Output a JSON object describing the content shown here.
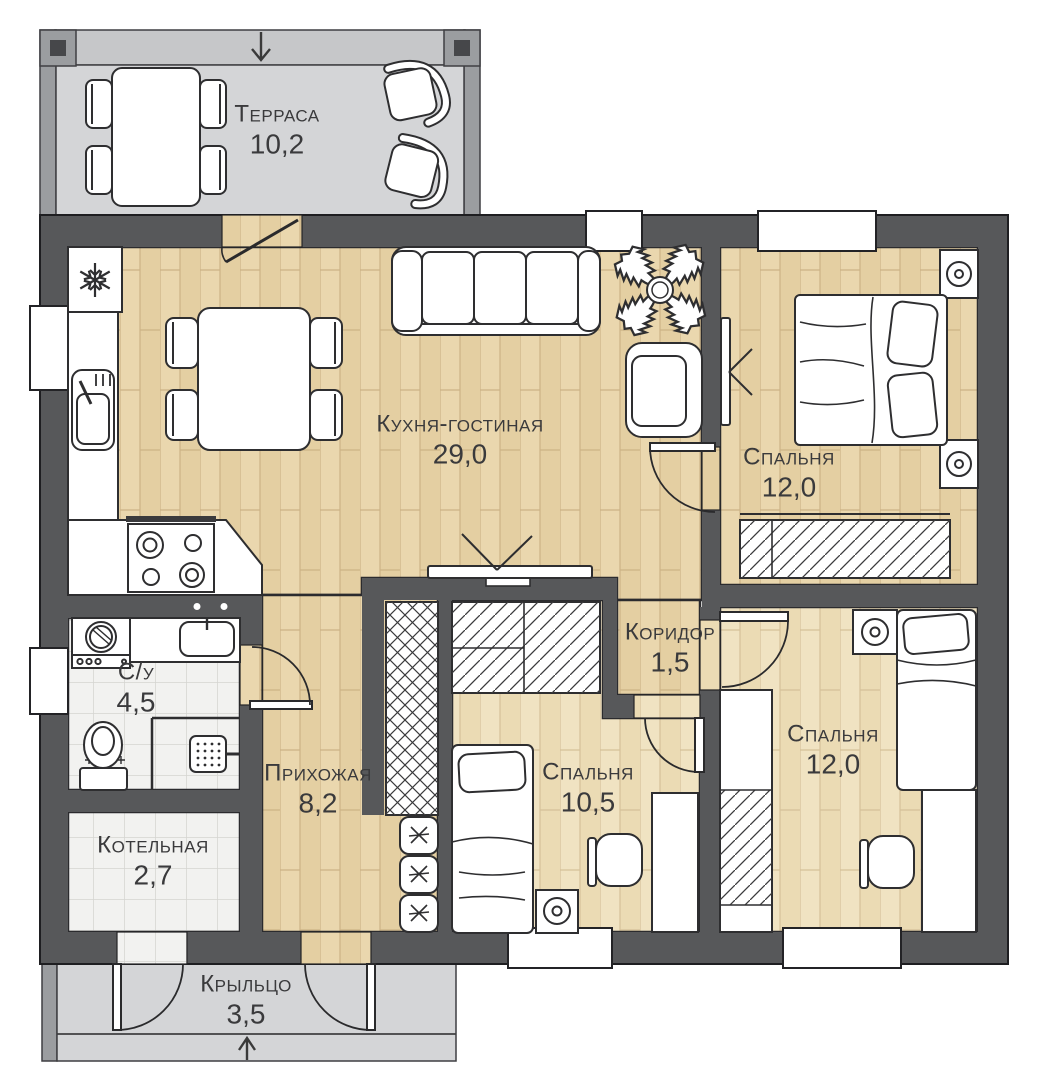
{
  "plan": {
    "title": "Floor plan of a single-storey house",
    "rooms": [
      {
        "id": "terrace",
        "name": "Терраса",
        "area": "10,2"
      },
      {
        "id": "kitchen-living",
        "name": "Кухня-гостиная",
        "area": "29,0"
      },
      {
        "id": "bedroom-1",
        "name": "Спальня",
        "area": "12,0"
      },
      {
        "id": "corridor",
        "name": "Коридор",
        "area": "1,5"
      },
      {
        "id": "bathroom",
        "name": "С/у",
        "area": "4,5"
      },
      {
        "id": "hallway",
        "name": "Прихожая",
        "area": "8,2"
      },
      {
        "id": "boiler-room",
        "name": "Котельная",
        "area": "2,7"
      },
      {
        "id": "bedroom-2",
        "name": "Спальня",
        "area": "10,5"
      },
      {
        "id": "bedroom-3",
        "name": "Спальня",
        "area": "12,0"
      },
      {
        "id": "porch",
        "name": "Крыльцо",
        "area": "3,5"
      }
    ],
    "colors": {
      "wall": "#57585a",
      "outline": "#2b2b2e",
      "terrace_wall": "#9b9da0",
      "terrace_floor": "#d4d5d7",
      "wood_floor": "#ead7ae",
      "wood_floor_light": "#f0e3c2",
      "tile_floor": "#f2f2f0",
      "label_text": "#3a3a3c"
    },
    "icons": [
      "snowflake-icon",
      "plant-icon",
      "entry-arrow-icon",
      "lamp-icon",
      "shower-icon",
      "star-icon"
    ]
  }
}
